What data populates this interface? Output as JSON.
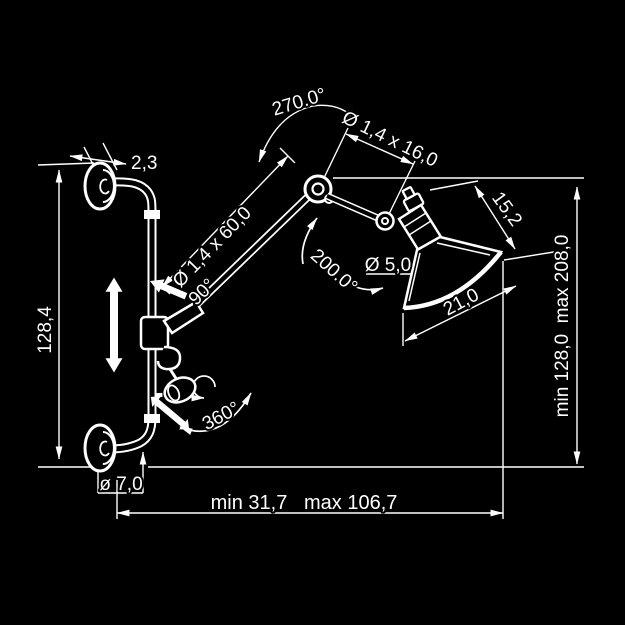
{
  "diagram": {
    "colors": {
      "background": "#000000",
      "line": "#ffffff",
      "text": "#ffffff"
    },
    "labels": {
      "flange_thickness": "2,3",
      "post_length": "128,4",
      "elbow_rotation": "270.0°",
      "lower_arm_spec": "Ø 1,4 x 60,0",
      "upper_arm_spec": "Ø 1,4 x 16,0",
      "shade_depth": "15,2",
      "arm_fold_angle": "90°",
      "head_tilt_angle": "200.0°",
      "socket_diameter": "Ø 5,0",
      "shade_diameter": "21,0",
      "swivel_angle": "360°",
      "tube_diameter": "ø 7,0",
      "height_range": "min 128,0  max 208,0",
      "reach_range": "min 31,7   max 106,7"
    }
  }
}
